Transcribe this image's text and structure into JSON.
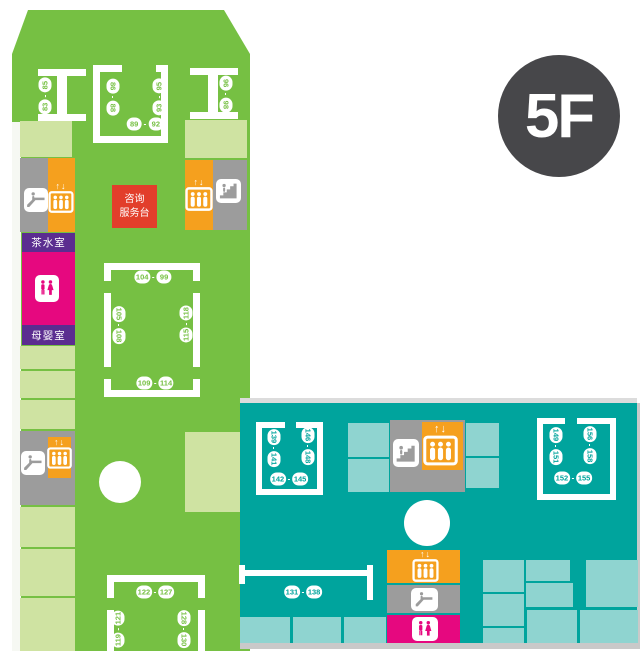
{
  "floor_badge": "5F",
  "ui": {
    "dash": "-",
    "elevator_arrows": "↑↓"
  },
  "facilities": {
    "info_desk_line1": "咨询",
    "info_desk_line2": "服务台",
    "tea_room": "茶水室",
    "nursing_room": "母婴室"
  },
  "icons": {
    "escalator": "escalator-icon",
    "stairs": "stairs-icon",
    "elevator": "elevator-icon",
    "restroom": "restroom-icon"
  },
  "colors": {
    "green": "#76c043",
    "pale_green": "#cfe3a2",
    "teal": "#00a49d",
    "light_teal": "#8fd4d0",
    "gray": "#9c9c9c",
    "orange": "#f5a01e",
    "red": "#e23e2b",
    "magenta": "#e6087f",
    "purple": "#5b2d90",
    "badge_gray": "#47474a"
  },
  "shops": {
    "r83_85": {
      "start": "83",
      "end": "85"
    },
    "r86_88": {
      "start": "86",
      "end": "88"
    },
    "r89_92": {
      "start": "89",
      "end": "92"
    },
    "r93_95": {
      "start": "93",
      "end": "95"
    },
    "r96_98": {
      "start": "96",
      "end": "98"
    },
    "r104_99": {
      "start": "104",
      "end": "99"
    },
    "r105_108": {
      "start": "105",
      "end": "108"
    },
    "r109_114": {
      "start": "109",
      "end": "114"
    },
    "r115_118": {
      "start": "115",
      "end": "118"
    },
    "r119_121": {
      "start": "119",
      "end": "121"
    },
    "r122_127": {
      "start": "122",
      "end": "127"
    },
    "r128_130": {
      "start": "128",
      "end": "130"
    },
    "r131_138": {
      "start": "131",
      "end": "138"
    },
    "r139_141": {
      "start": "139",
      "end": "141"
    },
    "r142_145": {
      "start": "142",
      "end": "145"
    },
    "r146_148": {
      "start": "146",
      "end": "148"
    },
    "r149_151": {
      "start": "149",
      "end": "151"
    },
    "r152_155": {
      "start": "152",
      "end": "155"
    },
    "r156_158": {
      "start": "156",
      "end": "158"
    }
  }
}
